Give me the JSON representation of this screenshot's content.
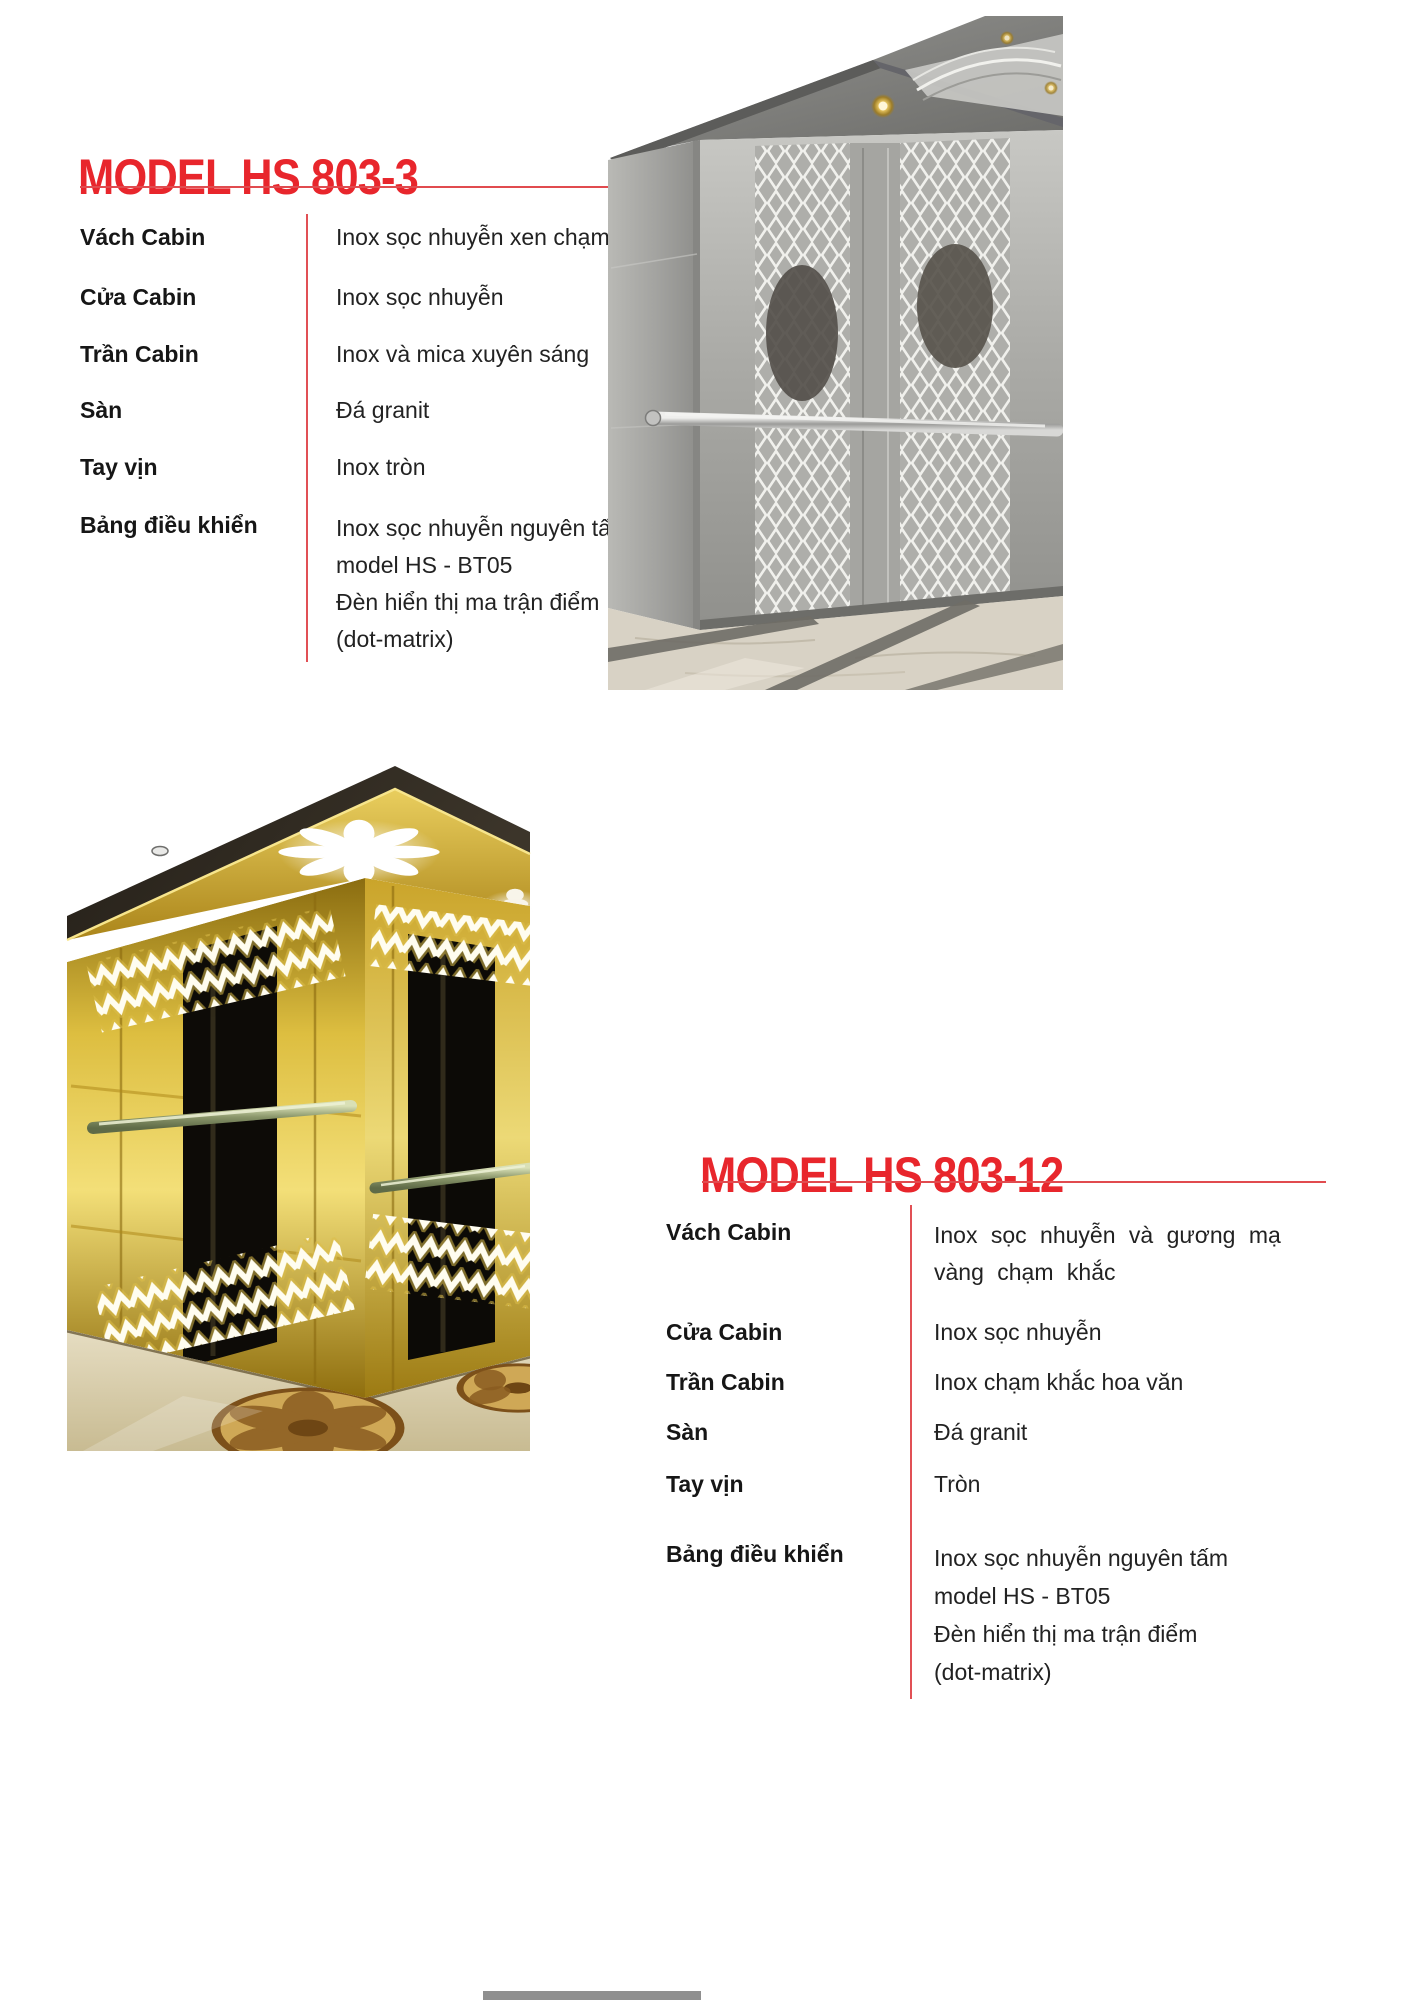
{
  "page": {
    "background": "#ffffff"
  },
  "theme": {
    "accent_red": "#e8262c",
    "rule_red": "#e14b4f",
    "text_color": "#1e1e1e"
  },
  "sections": [
    {
      "title": "MODEL HS 803-3",
      "image": "stainless-steel-elevator-cabin-interior",
      "specs": [
        {
          "label": "Vách Cabin",
          "value": "Inox sọc nhuyễn xen chạm khắc"
        },
        {
          "label": "Cửa Cabin",
          "value": "Inox sọc nhuyễn"
        },
        {
          "label": "Trần Cabin",
          "value": "Inox và mica xuyên sáng"
        },
        {
          "label": "Sàn",
          "value": "Đá granit"
        },
        {
          "label": "Tay vịn",
          "value": "Inox tròn"
        },
        {
          "label": "Bảng điều khiển",
          "value": "Inox sọc nhuyễn nguyên tấm\nmodel HS - BT05\nĐèn hiển thị ma trận điểm\n(dot-matrix)"
        }
      ]
    },
    {
      "title": "MODEL HS 803-12",
      "image": "gold-mirror-elevator-cabin-interior",
      "specs": [
        {
          "label": "Vách Cabin",
          "value": "Inox sọc nhuyễn và gương mạ\nvàng chạm khắc"
        },
        {
          "label": "Cửa Cabin",
          "value": "Inox sọc nhuyễn"
        },
        {
          "label": "Trần Cabin",
          "value": "Inox chạm khắc hoa văn"
        },
        {
          "label": "Sàn",
          "value": "Đá granit"
        },
        {
          "label": "Tay vịn",
          "value": "Tròn"
        },
        {
          "label": "Bảng điều khiển",
          "value": "Inox sọc nhuyễn nguyên tấm\nmodel HS - BT05\nĐèn hiển thị ma trận điểm\n(dot-matrix)"
        }
      ]
    }
  ]
}
